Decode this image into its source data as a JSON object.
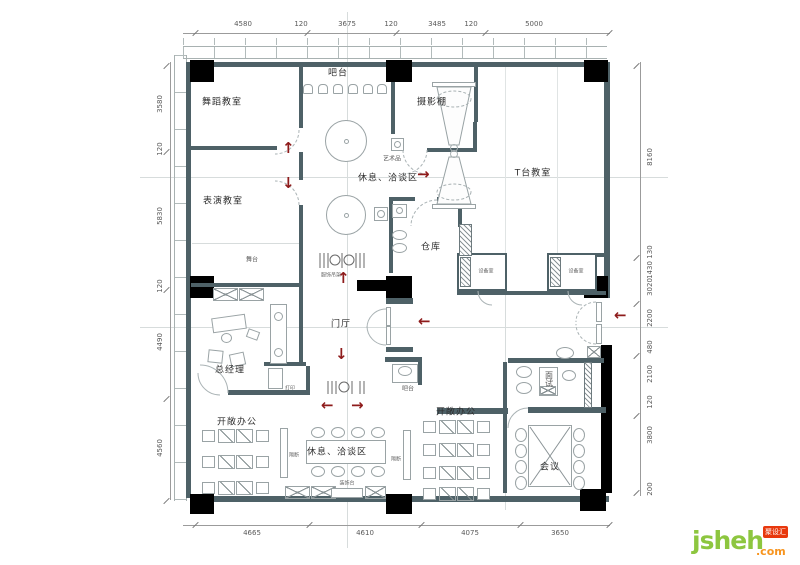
{
  "rooms": {
    "bar_top": "吧台",
    "dance": "舞蹈教室",
    "photo_studio": "摄影棚",
    "art_piece": "艺术品",
    "rest_talk_mid": "休息、洽谈区",
    "t_stage": "T台教室",
    "perform": "表演教室",
    "stage": "舞台",
    "warehouse": "仓库",
    "equip_a": "设备室",
    "equip_b": "设备室",
    "rack": "服饰吊架",
    "foyer": "门厅",
    "gm": "总经理",
    "print": "打印",
    "bar_small": "吧台",
    "interview": "面试",
    "office_left": "开敞办公",
    "office_right": "开敞办公",
    "rest_talk_bottom": "休息、洽谈区",
    "meeting": "会议",
    "screen_left": "隔断",
    "screen_right": "隔断",
    "console": "装饰台"
  },
  "dimensions": {
    "top": [
      "4580",
      "120",
      "3675",
      "120",
      "3485",
      "120",
      "5000"
    ],
    "left": [
      "3580",
      "120",
      "5830",
      "120",
      "4490",
      "4560"
    ],
    "right": [
      "8160",
      "130",
      "1430",
      "3020",
      "2200",
      "480",
      "2100",
      "120",
      "3800",
      "200"
    ],
    "bottom": [
      "4665",
      "4610",
      "4075",
      "3650"
    ]
  },
  "arrows": {
    "up": "↑",
    "down": "↓",
    "left": "←",
    "right": "→"
  },
  "logo": {
    "name": "jsheh",
    "tld": ".com",
    "badge": "聚设汇"
  },
  "colors": {
    "wall": "#4e6167",
    "column": "#000000",
    "arrow": "#8e1b1b",
    "logo_green": "#8dc63f",
    "logo_orange": "#f7941e",
    "badge_red": "#e8380d"
  }
}
